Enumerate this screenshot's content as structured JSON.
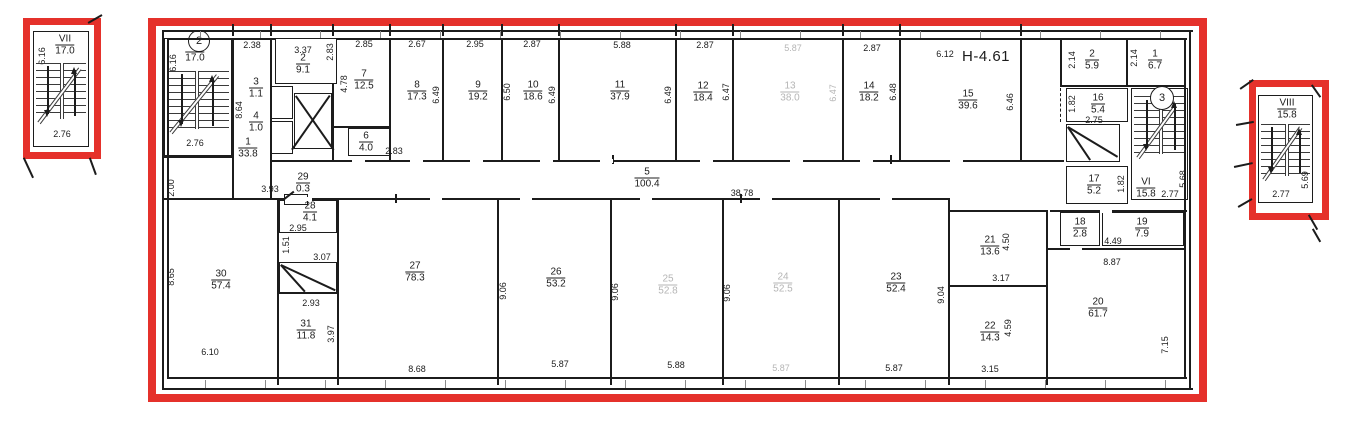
{
  "drawing": {
    "elevation_label": "H-4.61",
    "section_markers": {
      "left": "2",
      "right": "3"
    },
    "colors": {
      "frame_red": "#e5312b",
      "ink": "#1c1c1c",
      "faded_ink": "#b5b5b5"
    },
    "stairwells": {
      "detail_left": {
        "num": "VII",
        "area": "17.0",
        "width": "2.76",
        "height": "6.16"
      },
      "plan_left": {
        "num": "V",
        "area": "17.0",
        "width": "2.76",
        "height": "6.16"
      },
      "plan_right": {
        "num": "VI",
        "area": "15.8",
        "width": "2.77",
        "height": "5.68"
      },
      "detail_right": {
        "num": "VIII",
        "area": "15.8",
        "width": "2.77",
        "height": "5.69"
      }
    },
    "rooms": [
      {
        "n": "1",
        "a": "33.8",
        "x": 248,
        "y": 148
      },
      {
        "n": "2",
        "a": "9.1",
        "x": 303,
        "y": 64
      },
      {
        "n": "3",
        "a": "1.1",
        "x": 256,
        "y": 88
      },
      {
        "n": "4",
        "a": "1.0",
        "x": 256,
        "y": 122
      },
      {
        "n": "5",
        "a": "100.4",
        "x": 647,
        "y": 178
      },
      {
        "n": "6",
        "a": "4.0",
        "x": 366,
        "y": 142
      },
      {
        "n": "7",
        "a": "12.5",
        "x": 364,
        "y": 80
      },
      {
        "n": "8",
        "a": "17.3",
        "x": 417,
        "y": 91
      },
      {
        "n": "9",
        "a": "19.2",
        "x": 478,
        "y": 91
      },
      {
        "n": "10",
        "a": "18.6",
        "x": 533,
        "y": 91
      },
      {
        "n": "11",
        "a": "37.9",
        "x": 620,
        "y": 91
      },
      {
        "n": "12",
        "a": "18.4",
        "x": 703,
        "y": 92
      },
      {
        "n": "13",
        "a": "38.0",
        "x": 790,
        "y": 92,
        "f": true
      },
      {
        "n": "14",
        "a": "18.2",
        "x": 869,
        "y": 92
      },
      {
        "n": "15",
        "a": "39.6",
        "x": 968,
        "y": 100
      },
      {
        "n": "16",
        "a": "5.4",
        "x": 1098,
        "y": 104
      },
      {
        "n": "17",
        "a": "5.2",
        "x": 1094,
        "y": 185
      },
      {
        "n": "18",
        "a": "2.8",
        "x": 1080,
        "y": 228
      },
      {
        "n": "19",
        "a": "7.9",
        "x": 1142,
        "y": 228
      },
      {
        "n": "20",
        "a": "61.7",
        "x": 1098,
        "y": 308
      },
      {
        "n": "21",
        "a": "13.6",
        "x": 990,
        "y": 246
      },
      {
        "n": "22",
        "a": "14.3",
        "x": 990,
        "y": 332
      },
      {
        "n": "23",
        "a": "52.4",
        "x": 896,
        "y": 283
      },
      {
        "n": "24",
        "a": "52.5",
        "x": 783,
        "y": 283,
        "f": true
      },
      {
        "n": "25",
        "a": "52.8",
        "x": 668,
        "y": 285,
        "f": true
      },
      {
        "n": "26",
        "a": "53.2",
        "x": 556,
        "y": 278
      },
      {
        "n": "27",
        "a": "78.3",
        "x": 415,
        "y": 272
      },
      {
        "n": "28",
        "a": "4.1",
        "x": 310,
        "y": 212
      },
      {
        "n": "29",
        "a": "0.3",
        "x": 303,
        "y": 183
      },
      {
        "n": "30",
        "a": "57.4",
        "x": 221,
        "y": 280
      },
      {
        "n": "31",
        "a": "11.8",
        "x": 306,
        "y": 330
      },
      {
        "n": "2",
        "a": "5.9",
        "x": 1092,
        "y": 60
      },
      {
        "n": "1",
        "a": "6.7",
        "x": 1155,
        "y": 60
      }
    ],
    "dims": [
      {
        "t": "2.38",
        "x": 252,
        "y": 45
      },
      {
        "t": "3.37",
        "x": 303,
        "y": 50
      },
      {
        "t": "2.83",
        "x": 330,
        "y": 52,
        "v": 1
      },
      {
        "t": "2.85",
        "x": 364,
        "y": 44
      },
      {
        "t": "4.78",
        "x": 344,
        "y": 84,
        "v": 1
      },
      {
        "t": "2.67",
        "x": 417,
        "y": 44
      },
      {
        "t": "6.49",
        "x": 436,
        "y": 95,
        "v": 1
      },
      {
        "t": "2.95",
        "x": 475,
        "y": 44
      },
      {
        "t": "6.50",
        "x": 507,
        "y": 92,
        "v": 1
      },
      {
        "t": "2.87",
        "x": 532,
        "y": 44
      },
      {
        "t": "6.49",
        "x": 552,
        "y": 95,
        "v": 1
      },
      {
        "t": "5.88",
        "x": 622,
        "y": 45
      },
      {
        "t": "6.49",
        "x": 668,
        "y": 95,
        "v": 1
      },
      {
        "t": "2.87",
        "x": 705,
        "y": 45
      },
      {
        "t": "6.47",
        "x": 726,
        "y": 92,
        "v": 1
      },
      {
        "t": "5.87",
        "x": 793,
        "y": 48,
        "f": 1
      },
      {
        "t": "6.47",
        "x": 833,
        "y": 93,
        "v": 1,
        "f": 1
      },
      {
        "t": "2.87",
        "x": 872,
        "y": 48
      },
      {
        "t": "6.48",
        "x": 893,
        "y": 92,
        "v": 1
      },
      {
        "t": "6.12",
        "x": 945,
        "y": 54
      },
      {
        "t": "6.46",
        "x": 1010,
        "y": 102,
        "v": 1
      },
      {
        "t": "2.14",
        "x": 1072,
        "y": 60,
        "v": 1
      },
      {
        "t": "2.14",
        "x": 1134,
        "y": 58,
        "v": 1
      },
      {
        "t": "1.82",
        "x": 1072,
        "y": 104,
        "v": 1
      },
      {
        "t": "2.75",
        "x": 1094,
        "y": 120
      },
      {
        "t": "1.82",
        "x": 1121,
        "y": 184,
        "v": 1
      },
      {
        "t": "8.64",
        "x": 239,
        "y": 110,
        "v": 1
      },
      {
        "t": "2.00",
        "x": 171,
        "y": 188,
        "v": 1
      },
      {
        "t": "2.83",
        "x": 394,
        "y": 151
      },
      {
        "t": "3.93",
        "x": 270,
        "y": 189
      },
      {
        "t": "38.78",
        "x": 742,
        "y": 193
      },
      {
        "t": "2.95",
        "x": 298,
        "y": 228
      },
      {
        "t": "1.51",
        "x": 286,
        "y": 245,
        "v": 1
      },
      {
        "t": "3.07",
        "x": 322,
        "y": 257
      },
      {
        "t": "2.93",
        "x": 311,
        "y": 303
      },
      {
        "t": "3.97",
        "x": 331,
        "y": 334,
        "v": 1
      },
      {
        "t": "8.65",
        "x": 171,
        "y": 277,
        "v": 1
      },
      {
        "t": "6.10",
        "x": 210,
        "y": 352
      },
      {
        "t": "8.68",
        "x": 417,
        "y": 369
      },
      {
        "t": "9.06",
        "x": 503,
        "y": 291,
        "v": 1
      },
      {
        "t": "5.87",
        "x": 560,
        "y": 364
      },
      {
        "t": "9.06",
        "x": 615,
        "y": 292,
        "v": 1
      },
      {
        "t": "5.88",
        "x": 676,
        "y": 365
      },
      {
        "t": "9.06",
        "x": 727,
        "y": 293,
        "v": 1
      },
      {
        "t": "5.87",
        "x": 781,
        "y": 368,
        "f": 1
      },
      {
        "t": "9.04",
        "x": 941,
        "y": 295,
        "v": 1
      },
      {
        "t": "5.87",
        "x": 894,
        "y": 368
      },
      {
        "t": "4.50",
        "x": 1006,
        "y": 242,
        "v": 1
      },
      {
        "t": "3.17",
        "x": 1001,
        "y": 278
      },
      {
        "t": "4.59",
        "x": 1008,
        "y": 328,
        "v": 1
      },
      {
        "t": "3.15",
        "x": 990,
        "y": 369
      },
      {
        "t": "4.49",
        "x": 1113,
        "y": 241
      },
      {
        "t": "8.87",
        "x": 1112,
        "y": 262
      },
      {
        "t": "7.15",
        "x": 1165,
        "y": 345,
        "v": 1
      }
    ]
  }
}
